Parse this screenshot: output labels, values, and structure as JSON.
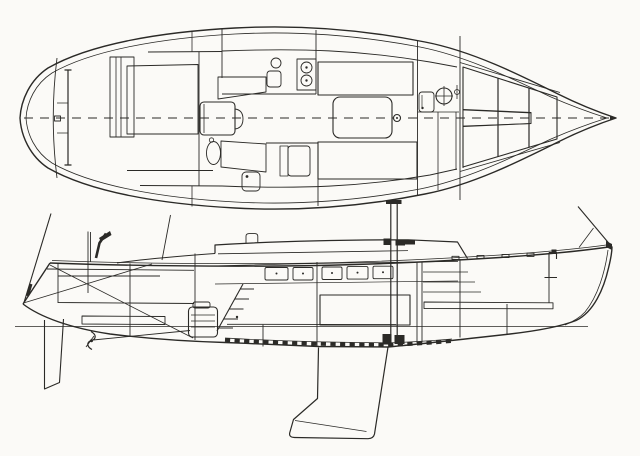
{
  "figure": {
    "kind": "scanned line drawing, black ink on white paper, no text labels",
    "subject": "sailboat general arrangement",
    "colors": {
      "paper": "#fbfaf7",
      "ink": "#2b2a27"
    },
    "views": {
      "plan": {
        "label": "Deck and accommodation plan, bow pointing right",
        "parts": [
          "transom",
          "mainsheet-traveler",
          "lazarette-hatch",
          "cockpit-grating",
          "companionway-hatch",
          "galley-sink",
          "galley-stove-two-burners",
          "icebox",
          "quarter-berth-port",
          "quarter-berth-starboard",
          "settee-starboard",
          "settee-port",
          "saloon-table",
          "mast",
          "head-sink",
          "toilet",
          "v-berth",
          "centerline"
        ]
      },
      "profile": {
        "label": "Interior profile elevation, bow pointing right",
        "parts": [
          "backstay",
          "transom",
          "rudder",
          "propeller",
          "prop-shaft",
          "engine",
          "quarter-berth",
          "cockpit-coaming",
          "companionway-ladder",
          "cabin-trunk",
          "cabin-windows",
          "mast",
          "gooseneck",
          "mast-step",
          "settee-front-slats",
          "fin-keel",
          "floor-tick-strip",
          "waterline",
          "v-berth-shelf",
          "bow-fitting",
          "forestay",
          "genoa-track-blocks"
        ]
      }
    }
  }
}
